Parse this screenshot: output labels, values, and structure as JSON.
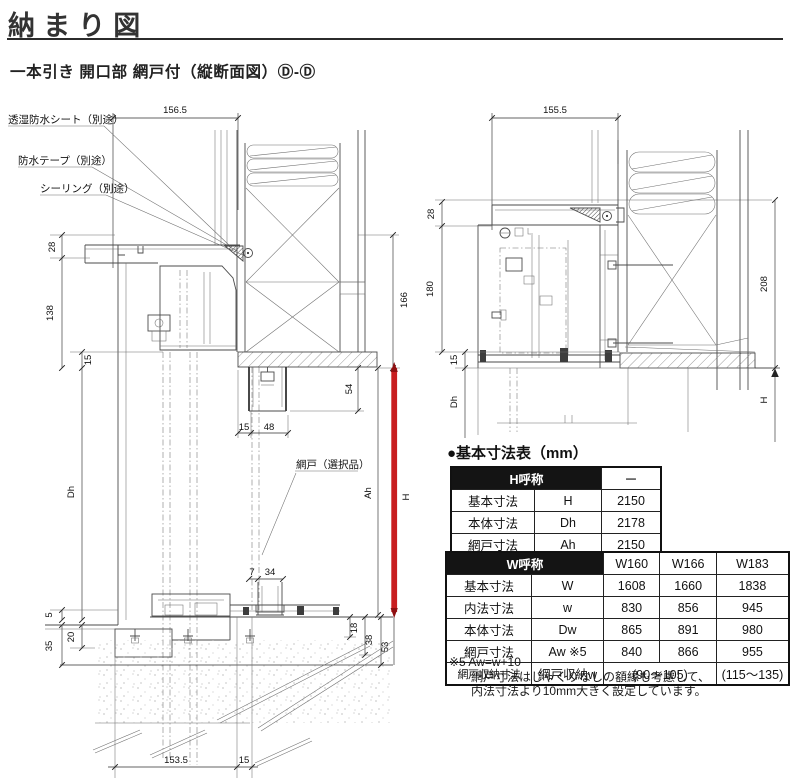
{
  "page": {
    "title": "納まり図",
    "subtitle": "一本引き 開口部 網戸付（縦断面図）Ⓓ-Ⓓ"
  },
  "left_drawing": {
    "dim_top": "156.5",
    "dim_a": "28",
    "dim_b": "138",
    "dim_c": "15",
    "dim_dh": "Dh",
    "dim_166": "166",
    "dim_54": "54",
    "dim_15": "15",
    "dim_48": "48",
    "dim_7": "7",
    "dim_34": "34",
    "dim_5": "5",
    "dim_20": "20",
    "dim_35": "35",
    "dim_18": "18",
    "dim_38": "38",
    "dim_53": "53",
    "dim_ah": "Ah",
    "dim_h": "H",
    "dim_bottom": "153.5",
    "dim_bottom2": "15",
    "callout_sheet": "透湿防水シート（別途）",
    "callout_tape": "防水テープ（別途）",
    "callout_seal": "シーリング（別途）",
    "callout_screen": "網戸（選択品）",
    "accent_red": "#c81e20"
  },
  "right_drawing": {
    "dim_top": "155.5",
    "dim_a": "28",
    "dim_b": "180",
    "dim_c": "15",
    "dim_dh": "Dh",
    "dim_208": "208",
    "dim_h": "H"
  },
  "tables": {
    "heading": "●基本寸法表（mm）",
    "h_table": {
      "title": "H呼称",
      "col": "ー",
      "rows": [
        [
          "基本寸法",
          "H",
          "2150"
        ],
        [
          "本体寸法",
          "Dh",
          "2178"
        ],
        [
          "網戸寸法",
          "Ah",
          "2150"
        ]
      ]
    },
    "w_table": {
      "title": "W呼称",
      "cols": [
        "W160",
        "W166",
        "W183"
      ],
      "rows": [
        [
          "基本寸法",
          "W",
          "1608",
          "1660",
          "1838"
        ],
        [
          "内法寸法",
          "w",
          "830",
          "856",
          "945"
        ],
        [
          "本体寸法",
          "Dw",
          "865",
          "891",
          "980"
        ],
        [
          "網戸寸法",
          "Aw ※5",
          "840",
          "866",
          "955"
        ]
      ],
      "storage_row": {
        "label": "網戸収納寸法",
        "sub": "網戸収納w",
        "val_span": "(90～105)",
        "val_last": "(115～135)"
      }
    },
    "footnote": {
      "line1": "※5 Aw=w+10",
      "line2": "網戸寸法はじゃくりなしの額縁も考慮して、",
      "line3": "内法寸法より10mm大きく設定しています。"
    }
  }
}
